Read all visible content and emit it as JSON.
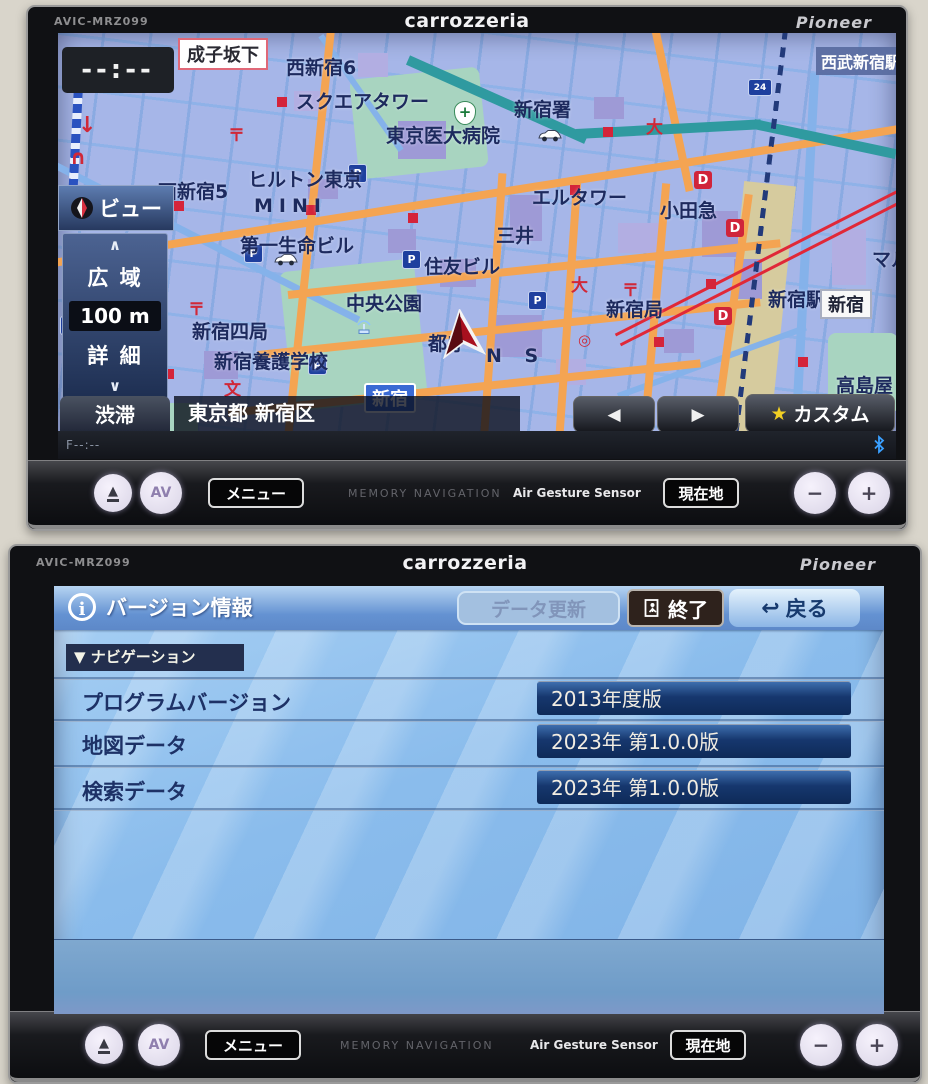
{
  "device": {
    "model": "AVIC-MRZ099",
    "brand": "carrozzeria",
    "maker": "Pioneer"
  },
  "hardware": {
    "eject_icon": "▲",
    "av_label": "AV",
    "menu_label": "メニュー",
    "memory_navigation": "MEMORY NAVIGATION",
    "air_gesture": "Air Gesture Sensor",
    "current_location_label": "現在地",
    "minus_icon": "−",
    "plus_icon": "+"
  },
  "map_screen": {
    "clock": "--:--",
    "view_label": "ビュー",
    "scale_up_icon": "∧",
    "scale_wide": "広 域",
    "scale_value": "100 m",
    "scale_detail": "詳 細",
    "scale_down_icon": "∨",
    "traffic_label": "渋滞",
    "location_text": "東京都 新宿区",
    "prev_icon": "◀",
    "next_icon": "▶",
    "custom_star_icon": "★",
    "custom_label": "カスタム",
    "sub_status": "F--:--",
    "labels": {
      "narikozaka": "成子坂下",
      "nishishinjuku6": "西新宿6",
      "honcho1": "本町1",
      "square_tower": "スクエアタワー",
      "shinjuku_sho": "新宿署",
      "tokyo_medical": "東京医大病院",
      "seibu_shinjuku": "西武新宿駅",
      "hilton": "ヒルトン東京",
      "mini": "MINI",
      "l_tower": "エルタワー",
      "odakyu": "小田急",
      "mitsui": "三井",
      "daiichi_seimei": "第一生命ビル",
      "sumitomo": "住友ビル",
      "nishishinjuku5": "西新宿5",
      "chuo_koen": "中央公園",
      "shinjuku4_kyoku": "新宿四局",
      "yogo_gakko": "新宿養護学校",
      "tocho": "都庁",
      "ns": "N S",
      "shinjuku_kyoku": "新宿局",
      "shinjuku_eki": "新宿駅",
      "shinjuku_sign": "新宿",
      "takashimaya": "高島屋",
      "maru": "マル"
    },
    "markers": {
      "dept": "D",
      "parking": "P",
      "parking24": "24",
      "post": "〒",
      "school": "文",
      "large": "大",
      "circle": "◎",
      "down_arrow": "↓",
      "arch": "∩",
      "hospital_cross": "+"
    }
  },
  "version_screen": {
    "info_icon": "i",
    "title": "バージョン情報",
    "update_label": "データ更新",
    "exit_label": "終了",
    "back_icon": "↩",
    "back_label": "戻る",
    "section_label": "▼ ナビゲーション",
    "rows": [
      {
        "label": "プログラムバージョン",
        "value": "2013年度版"
      },
      {
        "label": "地図データ",
        "value": "2023年 第1.0.0版"
      },
      {
        "label": "検索データ",
        "value": "2023年 第1.0.0版"
      }
    ]
  }
}
